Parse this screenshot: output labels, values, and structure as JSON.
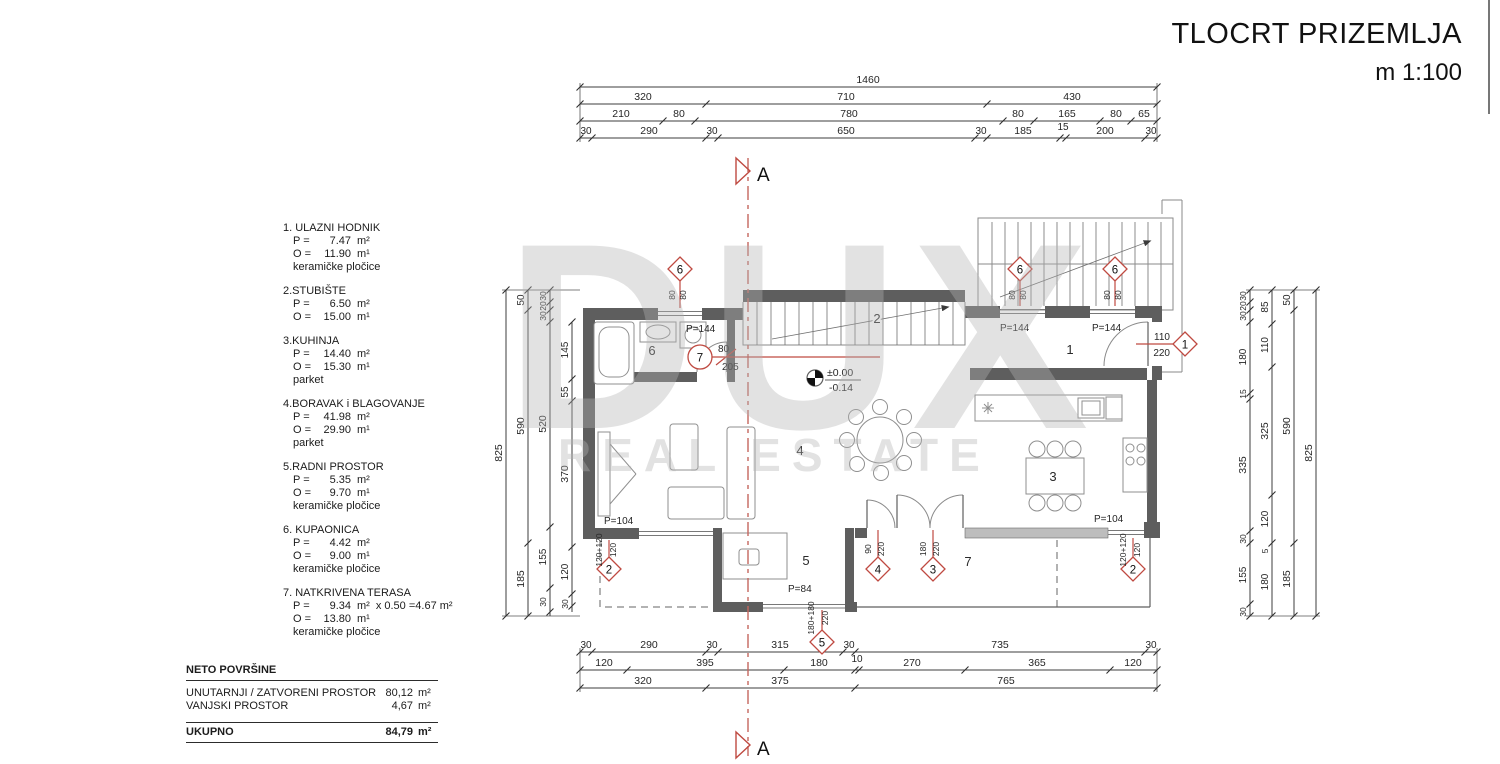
{
  "title": {
    "line1": "TLOCRT PRIZEMLJA",
    "line2": "m 1:100"
  },
  "legend": {
    "rooms": [
      {
        "name": "1. ULAZNI HODNIK",
        "p_label": "P =",
        "p_value": "7.47",
        "p_unit": "m²",
        "o_label": "O =",
        "o_value": "11.90",
        "o_unit": "m¹",
        "floor": "keramičke pločice"
      },
      {
        "name": "2.STUBIŠTE",
        "p_label": "P =",
        "p_value": "6.50",
        "p_unit": "m²",
        "o_label": "O =",
        "o_value": "15.00",
        "o_unit": "m¹",
        "floor": ""
      },
      {
        "name": "3.KUHINJA",
        "p_label": "P =",
        "p_value": "14.40",
        "p_unit": "m²",
        "o_label": "O =",
        "o_value": "15.30",
        "o_unit": "m¹",
        "floor": "parket"
      },
      {
        "name": "4.BORAVAK i BLAGOVANJE",
        "p_label": "P =",
        "p_value": "41.98",
        "p_unit": "m²",
        "o_label": "O =",
        "o_value": "29.90",
        "o_unit": "m¹",
        "floor": "parket"
      },
      {
        "name": "5.RADNI PROSTOR",
        "p_label": "P =",
        "p_value": "5.35",
        "p_unit": "m²",
        "o_label": "O =",
        "o_value": "9.70",
        "o_unit": "m¹",
        "floor": "keramičke pločice"
      },
      {
        "name": "6. KUPAONICA",
        "p_label": "P =",
        "p_value": "4.42",
        "p_unit": "m²",
        "o_label": "O =",
        "o_value": "9.00",
        "o_unit": "m¹",
        "floor": "keramičke pločice"
      },
      {
        "name": "7. NATKRIVENA TERASA",
        "p_label": "P =",
        "p_value": "9.34",
        "p_unit": "m²",
        "p_extra": "x 0.50 =4.67  m²",
        "o_label": "O =",
        "o_value": "13.80",
        "o_unit": "m¹",
        "floor": "keramičke pločice"
      }
    ],
    "summary": {
      "heading": "NETO POVRŠINE",
      "rows": [
        {
          "label": "UNUTARNJI / ZATVORENI PROSTOR",
          "value": "80,12",
          "unit": "m²"
        },
        {
          "label": "VANJSKI PROSTOR",
          "value": "4,67",
          "unit": "m²"
        }
      ],
      "total_label": "UKUPNO",
      "total_value": "84,79",
      "total_unit": "m²"
    }
  },
  "dims": {
    "top": {
      "row1": [
        "1460"
      ],
      "row2": [
        "320",
        "710",
        "430"
      ],
      "row3": [
        "210",
        "80",
        "780",
        "80",
        "165",
        "80",
        "65"
      ],
      "row4": [
        "30",
        "290",
        "30",
        "650",
        "30",
        "185",
        "15",
        "200",
        "30"
      ]
    },
    "bottom": {
      "row1": [
        "30",
        "290",
        "30",
        "315",
        "30",
        "735",
        "30"
      ],
      "row2": [
        "120",
        "395",
        "180",
        "10",
        "270",
        "365",
        "120"
      ],
      "row3": [
        "320",
        "375",
        "765"
      ]
    },
    "left": {
      "total": [
        "825"
      ],
      "outer": [
        "50",
        "590",
        "185"
      ],
      "mid": [
        "30",
        "20",
        "30",
        "520",
        "155",
        "30"
      ],
      "inner": [
        "145",
        "55",
        "370",
        "120",
        "30"
      ]
    },
    "right": {
      "inner": [
        "30",
        "20",
        "30",
        "180",
        "15",
        "335",
        "30",
        "155",
        "30"
      ],
      "mid": [
        "85",
        "110",
        "325",
        "120",
        "5",
        "180"
      ],
      "outer": [
        "50",
        "590",
        "185"
      ],
      "total": [
        "825"
      ]
    }
  },
  "plan": {
    "rooms": {
      "r1": "1",
      "r2": "2",
      "r3": "3",
      "r4": "4",
      "r5": "5",
      "r6": "6",
      "r7": "7"
    },
    "section_label": "A",
    "level": {
      "upper": "±0.00",
      "lower": "-0.14"
    },
    "markers": {
      "m6a": {
        "id": "6",
        "w": "80",
        "h": "80",
        "parapet": "P=144"
      },
      "m6b": {
        "id": "6",
        "w": "80",
        "h": "80",
        "parapet": "P=144"
      },
      "m6c": {
        "id": "6",
        "w": "80",
        "h": "80",
        "parapet": "P=144"
      },
      "m1": {
        "id": "1",
        "w": "110",
        "h": "220"
      },
      "m7": {
        "id": "7",
        "w": "80",
        "h": "205"
      },
      "m2a": {
        "id": "2",
        "w": "120+120",
        "h": "120",
        "parapet": "P=104"
      },
      "m2b": {
        "id": "2",
        "w": "120+120",
        "h": "120",
        "parapet": "P=104"
      },
      "m4": {
        "id": "4",
        "w": "90",
        "h": "220"
      },
      "m3": {
        "id": "3",
        "w": "180",
        "h": "220"
      },
      "m5": {
        "id": "5",
        "w": "180+180",
        "h": "220",
        "parapet": "P=84"
      }
    },
    "watermark": {
      "line1": "DUX",
      "line2": "REAL ESTATE"
    }
  }
}
